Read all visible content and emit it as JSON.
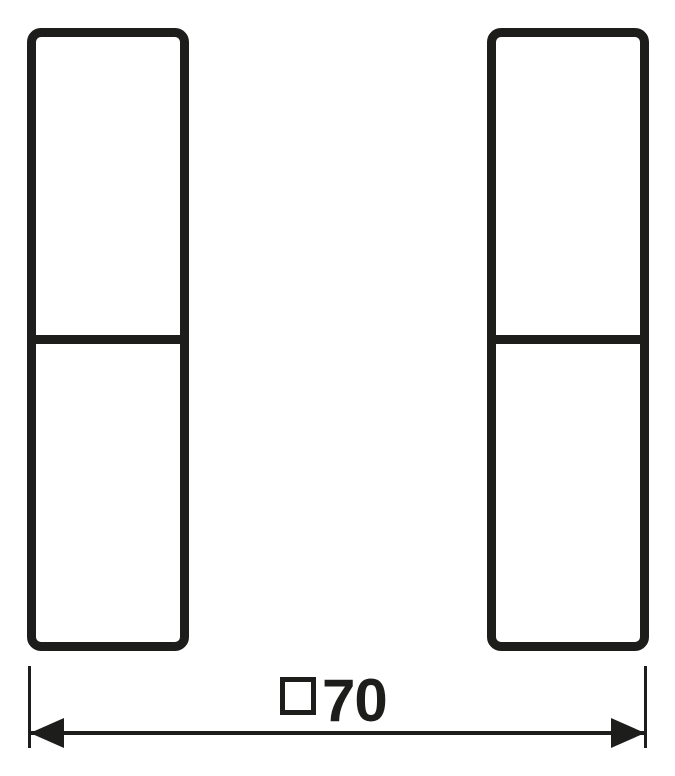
{
  "drawing": {
    "type": "technical-dimension-drawing",
    "background_color": "#ffffff",
    "stroke_color": "#1d1d1b",
    "rockers": [
      {
        "id": "left"
      },
      {
        "id": "right"
      }
    ],
    "dimension": {
      "symbol": "square",
      "value": "70",
      "full_label": "□70"
    }
  }
}
